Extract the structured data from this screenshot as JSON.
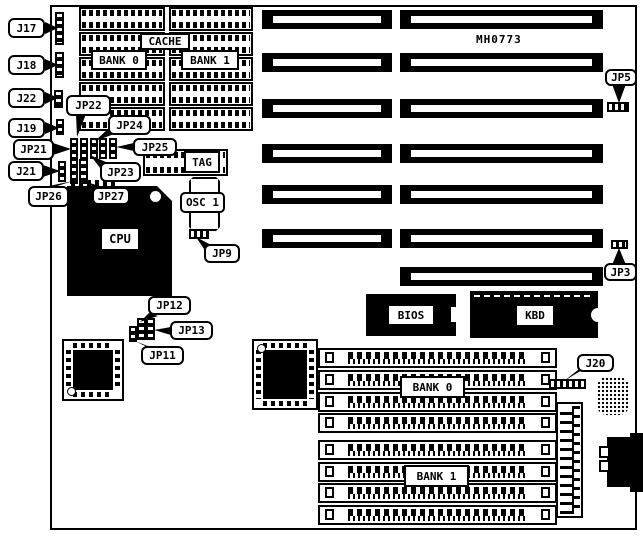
{
  "board": {
    "part_number": "MH0773"
  },
  "colors": {
    "line": "#000000",
    "background": "#ffffff"
  },
  "chips": {
    "cache_label": "CACHE",
    "cache_bank0_label": "BANK 0",
    "cache_bank1_label": "BANK 1",
    "tag_label": "TAG",
    "osc1_label": "OSC 1",
    "cpu_label": "CPU",
    "bios_label": "BIOS",
    "kbd_label": "KBD",
    "simm_bank0_label": "BANK 0",
    "simm_bank1_label": "BANK 1"
  },
  "callouts": {
    "j17": "J17",
    "j18": "J18",
    "j22": "J22",
    "j19": "J19",
    "jp21": "JP21",
    "j21": "J21",
    "jp26": "JP26",
    "jp22": "JP22",
    "jp24": "JP24",
    "jp25": "JP25",
    "jp23": "JP23",
    "jp27": "JP27",
    "jp9": "JP9",
    "jp12": "JP12",
    "jp13": "JP13",
    "jp11": "JP11",
    "jp5": "JP5",
    "jp3": "JP3",
    "j20": "J20"
  }
}
